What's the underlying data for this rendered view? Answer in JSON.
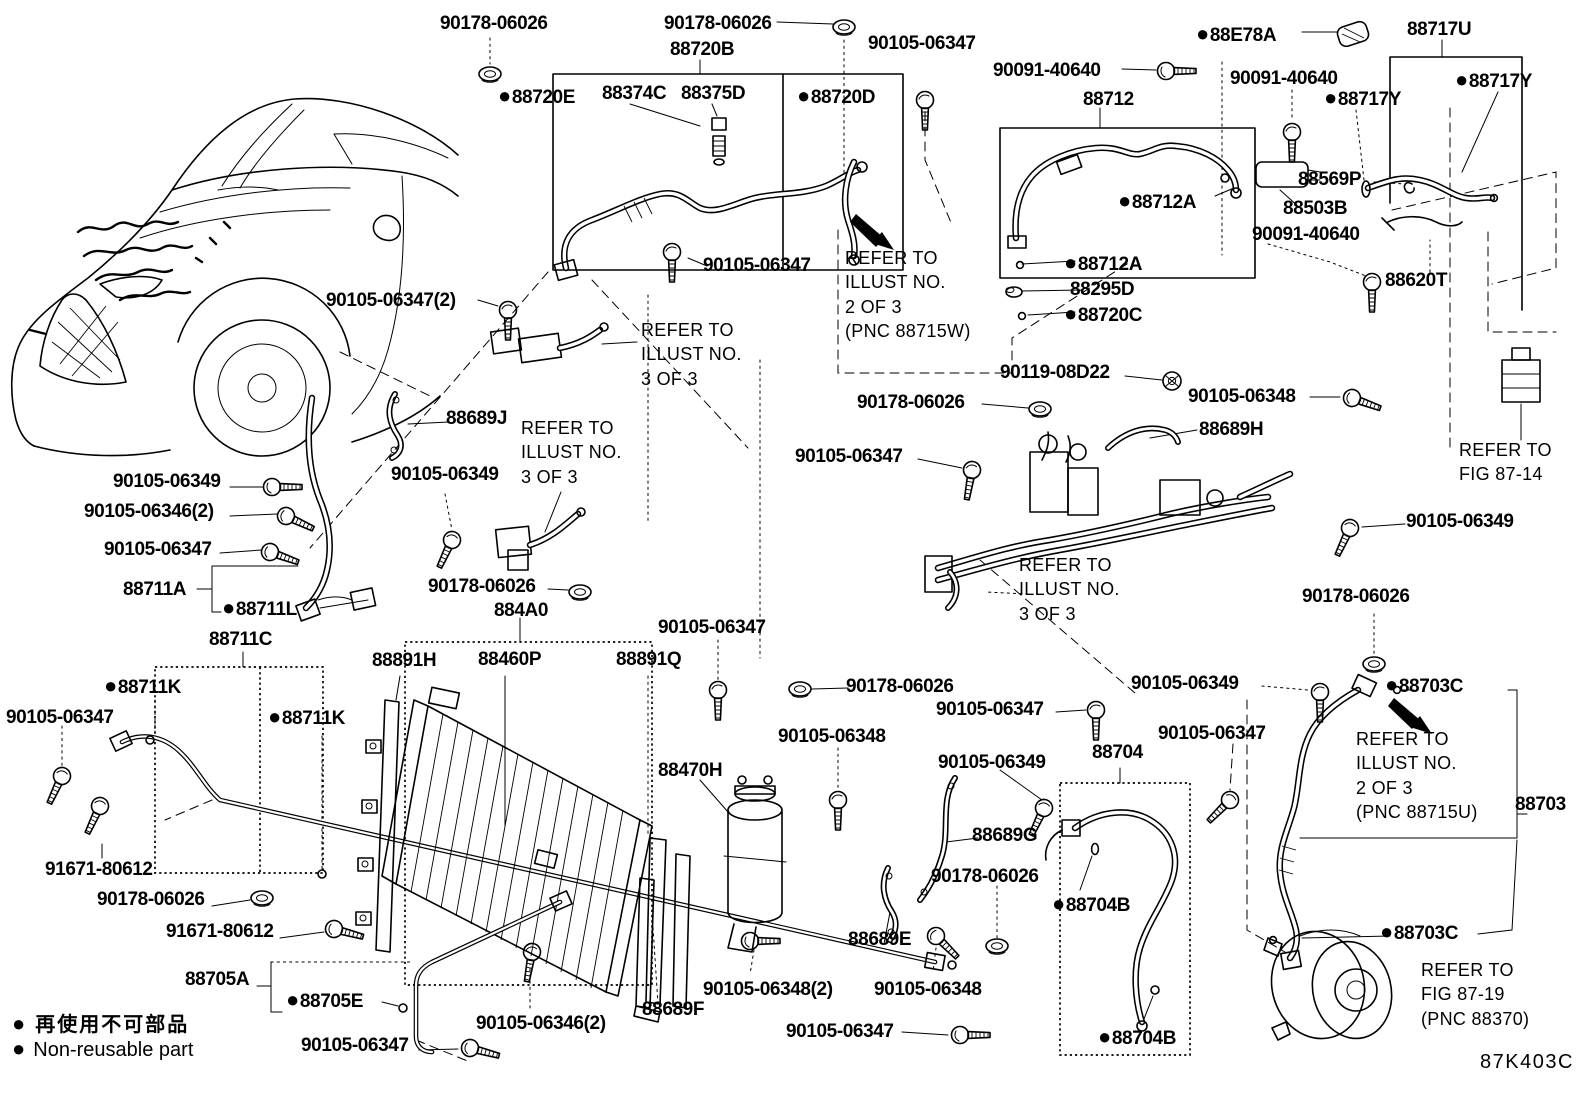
{
  "diagram_code": "87K403C",
  "legend": {
    "symbol": "●",
    "jp": "再使用不可部品",
    "en": "Non-reusable part"
  },
  "notes": {
    "illust_2of3_w": "REFER TO\nILLUST NO.\n2 OF 3\n(PNC 88715W)",
    "illust_2of3_u": "REFER TO\nILLUST NO.\n2 OF 3\n(PNC 88715U)",
    "illust_3of3": "REFER TO\nILLUST NO.\n3 OF 3",
    "fig_87_14": "REFER TO\nFIG 87-14",
    "fig_87_19": "REFER TO\nFIG 87-19\n(PNC 88370)"
  },
  "labels": [
    {
      "t": "90178-06026",
      "x": 440,
      "y": 14
    },
    {
      "t": "90178-06026",
      "x": 664,
      "y": 14
    },
    {
      "t": "90105-06347",
      "x": 868,
      "y": 34
    },
    {
      "t": "88720B",
      "x": 670,
      "y": 40
    },
    {
      "t": "88720E",
      "b": 1,
      "x": 498,
      "y": 84
    },
    {
      "t": "88374C",
      "x": 602,
      "y": 84
    },
    {
      "t": "88375D",
      "x": 681,
      "y": 84
    },
    {
      "t": "88720D",
      "b": 1,
      "x": 797,
      "y": 84
    },
    {
      "t": "88E78A",
      "b": 1,
      "x": 1196,
      "y": 22
    },
    {
      "t": "88717U",
      "x": 1407,
      "y": 20
    },
    {
      "t": "88717Y",
      "b": 1,
      "x": 1455,
      "y": 68
    },
    {
      "t": "90091-40640",
      "x": 993,
      "y": 61
    },
    {
      "t": "90091-40640",
      "x": 1230,
      "y": 69
    },
    {
      "t": "88717Y",
      "b": 1,
      "x": 1324,
      "y": 86
    },
    {
      "t": "88712",
      "x": 1083,
      "y": 90
    },
    {
      "t": "88712A",
      "b": 1,
      "x": 1118,
      "y": 189
    },
    {
      "t": "88569P",
      "x": 1298,
      "y": 170
    },
    {
      "t": "88503B",
      "x": 1283,
      "y": 199
    },
    {
      "t": "90091-40640",
      "x": 1252,
      "y": 225
    },
    {
      "t": "88620T",
      "x": 1385,
      "y": 271
    },
    {
      "t": "88712A",
      "b": 1,
      "x": 1064,
      "y": 251
    },
    {
      "t": "88295D",
      "x": 1070,
      "y": 280
    },
    {
      "t": "88720C",
      "b": 1,
      "x": 1064,
      "y": 302
    },
    {
      "t": "90105-06347",
      "x": 703,
      "y": 256
    },
    {
      "t": "90105-06347(2)",
      "x": 326,
      "y": 291
    },
    {
      "t": "88689J",
      "x": 446,
      "y": 409
    },
    {
      "t": "90105-06349",
      "x": 391,
      "y": 465
    },
    {
      "t": "90105-06349",
      "x": 113,
      "y": 472
    },
    {
      "t": "90105-06346(2)",
      "x": 84,
      "y": 502
    },
    {
      "t": "90105-06347",
      "x": 104,
      "y": 540
    },
    {
      "t": "90178-06026",
      "x": 428,
      "y": 577
    },
    {
      "t": "884A0",
      "x": 494,
      "y": 601
    },
    {
      "t": "88711A",
      "x": 123,
      "y": 580
    },
    {
      "t": "88711L",
      "b": 1,
      "x": 222,
      "y": 596
    },
    {
      "t": "88711C",
      "x": 209,
      "y": 630
    },
    {
      "t": "88711K",
      "b": 1,
      "x": 104,
      "y": 674
    },
    {
      "t": "88711K",
      "b": 1,
      "x": 268,
      "y": 705
    },
    {
      "t": "90105-06347",
      "x": 6,
      "y": 708
    },
    {
      "t": "90178-06026",
      "x": 857,
      "y": 393
    },
    {
      "t": "90119-08D22",
      "x": 1000,
      "y": 363
    },
    {
      "t": "90105-06347",
      "x": 795,
      "y": 447
    },
    {
      "t": "90105-06348",
      "x": 1188,
      "y": 387
    },
    {
      "t": "88689H",
      "x": 1199,
      "y": 420
    },
    {
      "t": "90105-06349",
      "x": 1406,
      "y": 512
    },
    {
      "t": "88891H",
      "x": 372,
      "y": 651
    },
    {
      "t": "88460P",
      "x": 478,
      "y": 650
    },
    {
      "t": "88891Q",
      "x": 616,
      "y": 650
    },
    {
      "t": "90105-06347",
      "x": 658,
      "y": 618
    },
    {
      "t": "88470H",
      "x": 658,
      "y": 761
    },
    {
      "t": "90105-06348",
      "x": 778,
      "y": 727
    },
    {
      "t": "90178-06026",
      "x": 846,
      "y": 677
    },
    {
      "t": "90105-06347",
      "x": 936,
      "y": 700
    },
    {
      "t": "90105-06349",
      "x": 938,
      "y": 753
    },
    {
      "t": "88689G",
      "x": 972,
      "y": 826
    },
    {
      "t": "90178-06026",
      "x": 931,
      "y": 867
    },
    {
      "t": "88704",
      "x": 1092,
      "y": 743
    },
    {
      "t": "88704B",
      "b": 1,
      "x": 1052,
      "y": 892
    },
    {
      "t": "88704B",
      "b": 1,
      "x": 1098,
      "y": 1025
    },
    {
      "t": "90105-06349",
      "x": 1131,
      "y": 674
    },
    {
      "t": "90105-06347",
      "x": 1158,
      "y": 724
    },
    {
      "t": "90178-06026",
      "x": 1302,
      "y": 587
    },
    {
      "t": "88703C",
      "b": 1,
      "x": 1385,
      "y": 673
    },
    {
      "t": "88703",
      "x": 1515,
      "y": 795
    },
    {
      "t": "88703C",
      "b": 1,
      "x": 1380,
      "y": 920
    },
    {
      "t": "91671-80612",
      "x": 45,
      "y": 860
    },
    {
      "t": "90178-06026",
      "x": 97,
      "y": 890
    },
    {
      "t": "91671-80612",
      "x": 166,
      "y": 922
    },
    {
      "t": "88705A",
      "x": 185,
      "y": 970
    },
    {
      "t": "88705E",
      "b": 1,
      "x": 286,
      "y": 988
    },
    {
      "t": "90105-06347",
      "x": 301,
      "y": 1036
    },
    {
      "t": "90105-06346(2)",
      "x": 476,
      "y": 1014
    },
    {
      "t": "88689F",
      "x": 642,
      "y": 1000
    },
    {
      "t": "90105-06348(2)",
      "x": 703,
      "y": 980
    },
    {
      "t": "90105-06348",
      "x": 874,
      "y": 980
    },
    {
      "t": "88689E",
      "x": 848,
      "y": 930
    },
    {
      "t": "90105-06347",
      "x": 786,
      "y": 1022
    },
    {
      "t": "REFER TO\nILLUST NO.\n2 OF 3\n(PNC 88715W)",
      "x": 845,
      "y": 246,
      "cls": "note"
    },
    {
      "t": "REFER TO\nILLUST NO.\n3 OF 3",
      "x": 641,
      "y": 318,
      "cls": "note"
    },
    {
      "t": "REFER TO\nILLUST NO.\n3 OF 3",
      "x": 521,
      "y": 416,
      "cls": "note"
    },
    {
      "t": "REFER TO\nILLUST NO.\n3 OF 3",
      "x": 1019,
      "y": 553,
      "cls": "note"
    },
    {
      "t": "REFER TO\nFIG 87-14",
      "x": 1459,
      "y": 438,
      "cls": "note"
    },
    {
      "t": "REFER TO\nILLUST NO.\n2 OF 3\n(PNC 88715U)",
      "x": 1356,
      "y": 727,
      "cls": "note"
    },
    {
      "t": "REFER TO\nFIG 87-19\n(PNC 88370)",
      "x": 1421,
      "y": 958,
      "cls": "note"
    }
  ]
}
